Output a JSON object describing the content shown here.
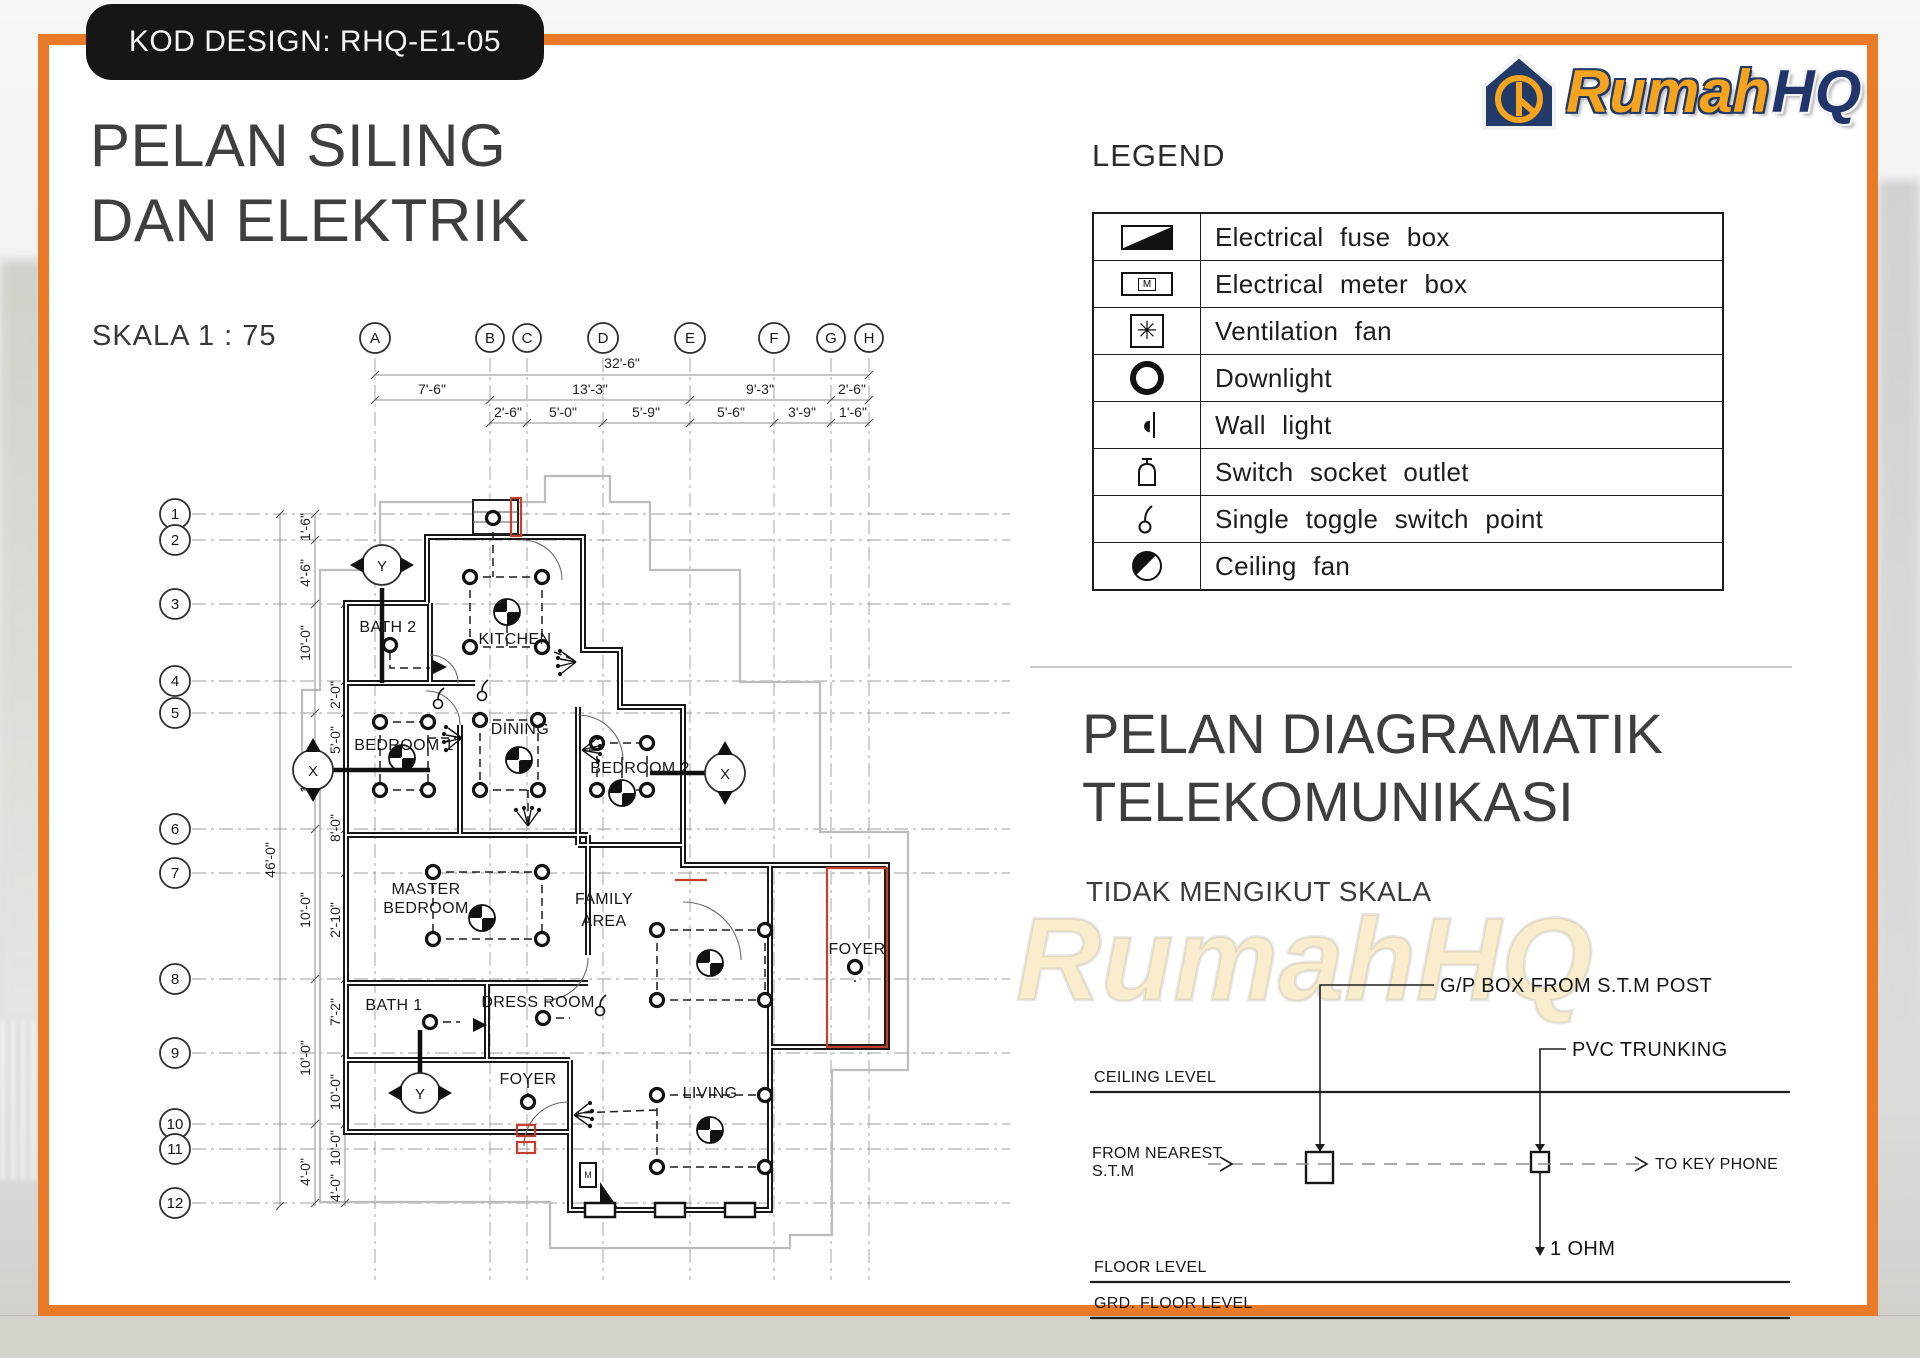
{
  "badge": {
    "label": "KOD DESIGN: RHQ-E1-05"
  },
  "titles": {
    "main_line1": "PELAN SILING",
    "main_line2": "DAN ELEKTRIK",
    "scale": "SKALA 1 : 75"
  },
  "logo": {
    "word1": "Rumah",
    "word2": "HQ"
  },
  "legend": {
    "title": "LEGEND",
    "vent_glyph": "✳",
    "wall_glyph": "◖",
    "items": [
      {
        "icon": "fuse-box-icon",
        "label": "Electrical fuse box"
      },
      {
        "icon": "meter-box-icon",
        "label": "Electrical meter box",
        "letter": "M"
      },
      {
        "icon": "ventilation-fan-icon",
        "label": "Ventilation fan"
      },
      {
        "icon": "downlight-icon",
        "label": "Downlight"
      },
      {
        "icon": "wall-light-icon",
        "label": "Wall light"
      },
      {
        "icon": "switch-socket-icon",
        "label": "Switch socket outlet"
      },
      {
        "icon": "toggle-switch-icon",
        "label": "Single toggle switch point"
      },
      {
        "icon": "ceiling-fan-icon",
        "label": "Ceiling fan"
      }
    ]
  },
  "section2": {
    "title_line1": "PELAN DIAGRAMATIK",
    "title_line2": "TELEKOMUNIKASI",
    "subtitle": "TIDAK MENGIKUT SKALA",
    "watermark": "RumahHQ"
  },
  "telecom": {
    "gp_box": "G/P BOX FROM  S.T.M  POST",
    "pvc": "PVC TRUNKING",
    "ceiling": "CEILING  LEVEL",
    "from_line1": "FROM  NEAREST",
    "from_line2": "S.T.M",
    "to_key": "TO  KEY  PHONE",
    "ohm": "1 OHM",
    "floor": "FLOOR  LEVEL",
    "grd": "GRD.  FLOOR  LEVEL"
  },
  "plan": {
    "grid_columns": [
      "A",
      "B",
      "C",
      "D",
      "E",
      "F",
      "G",
      "H"
    ],
    "grid_rows": [
      "1",
      "2",
      "3",
      "4",
      "5",
      "6",
      "7",
      "8",
      "9",
      "10",
      "11",
      "12"
    ],
    "dims_top": {
      "overall": "32'-6\"",
      "major": [
        "7'-6\"",
        "13'-3\"",
        "9'-3\"",
        "2'-6\""
      ],
      "minor": [
        "2'-6\"",
        "5'-0\"",
        "5'-9\"",
        "5'-6\"",
        "3'-9\"",
        "1'-6\""
      ]
    },
    "dims_left": {
      "overall": "46'-0\"",
      "outer": [
        "1'-6\"",
        "4'-6\"",
        "10'-0\"",
        "10'-0\"",
        "10'-0\"",
        "10'-0\"",
        "4'-0\""
      ],
      "inner": [
        "2'-0\"",
        "5'-0\"",
        "8'-0\"",
        "2'-10\"",
        "7'-2\"",
        "10'-0\"",
        "10'-0\"",
        "4'-0\""
      ]
    },
    "rooms": [
      {
        "label": "BATH 2"
      },
      {
        "label": "KITCHEN"
      },
      {
        "label": "BEDROOM 1"
      },
      {
        "label": "DINING"
      },
      {
        "label": "BEDROOM 2"
      },
      {
        "lines": [
          "MASTER",
          "BEDROOM"
        ]
      },
      {
        "lines": [
          "FAMILY",
          "AREA"
        ]
      },
      {
        "label": "BATH 1"
      },
      {
        "label": "DRESS ROOM"
      },
      {
        "label": "FOYER"
      },
      {
        "label": "LIVING"
      },
      {
        "label": "FOYER"
      }
    ],
    "markers": {
      "x": "X",
      "y": "Y"
    },
    "meter_label": "M"
  }
}
